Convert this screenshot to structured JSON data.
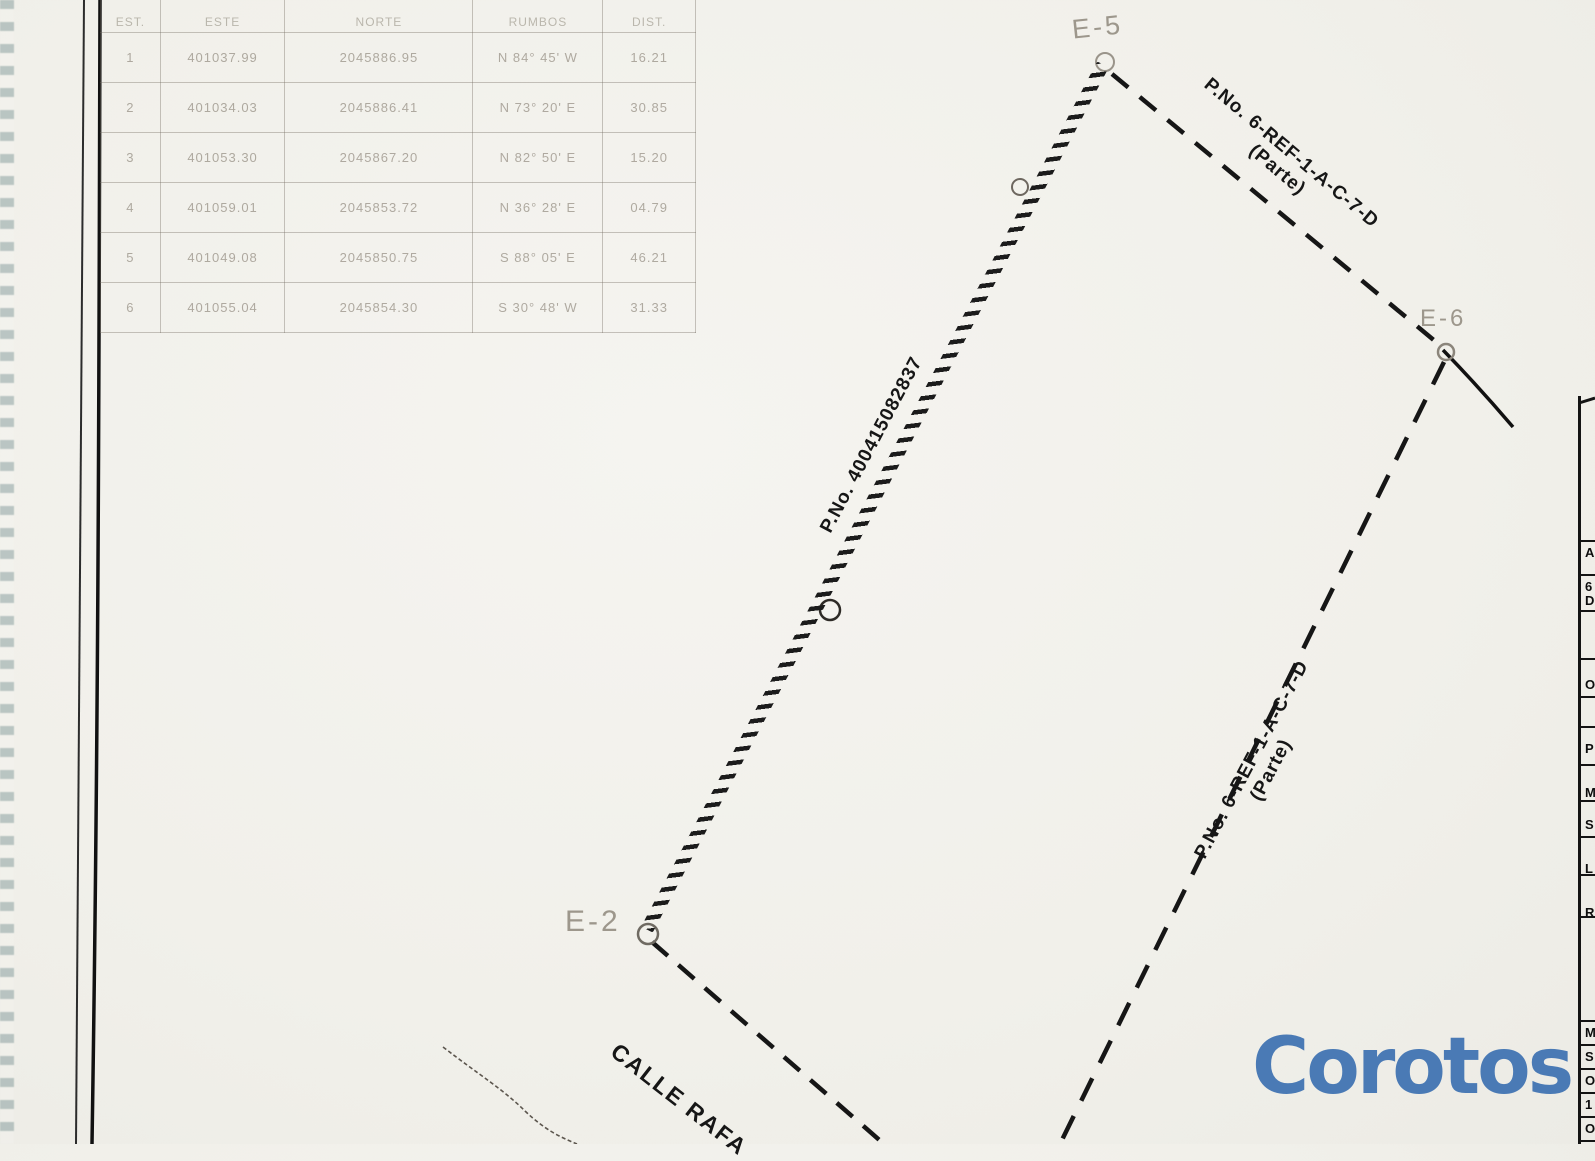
{
  "document_type": "scanned cadastral survey plan",
  "colors": {
    "paper": "#f1f0ea",
    "ink": "#161616",
    "pencil_faint": "#9d978c",
    "teal_scan_edge": "#5a9e9a",
    "watermark_blue": "#4a7ab5"
  },
  "coordinates_table": {
    "headers": [
      "EST.",
      "ESTE",
      "NORTE",
      "RUMBOS",
      "DIST."
    ],
    "rows": [
      [
        "1",
        "401037.99",
        "2045886.95",
        "N 84° 45' W",
        "16.21"
      ],
      [
        "2",
        "401034.03",
        "2045886.41",
        "N 73° 20' E",
        "30.85"
      ],
      [
        "3",
        "401053.30",
        "2045867.20",
        "N 82° 50' E",
        "15.20"
      ],
      [
        "4",
        "401059.01",
        "2045853.72",
        "N 36° 28' E",
        "04.79"
      ],
      [
        "5",
        "401049.08",
        "2045850.75",
        "S 88° 05' E",
        "46.21"
      ],
      [
        "6",
        "401055.04",
        "2045854.30",
        "S 30° 48' W",
        "31.33"
      ]
    ]
  },
  "parcel": {
    "stations": [
      {
        "label": "E-5"
      },
      {
        "label": "E-6"
      },
      {
        "label": "E-2"
      }
    ],
    "boundary_labels": [
      {
        "text": "P.No. 400415082837"
      },
      {
        "text": "P.No. 6-REF-1-A-C-7-D",
        "sub": "(Parte)"
      },
      {
        "text": "P.No. 6-REF-1-A-C-7-D",
        "sub": "(Parte)"
      }
    ],
    "street_label": "CALLE RAFA"
  },
  "right_strip": {
    "letters": [
      "A",
      "6",
      "D",
      "O",
      "P",
      "M",
      "S",
      "L",
      "R",
      "M",
      "S",
      "O",
      "1",
      "O"
    ]
  },
  "watermark": {
    "text": "Corotos"
  }
}
